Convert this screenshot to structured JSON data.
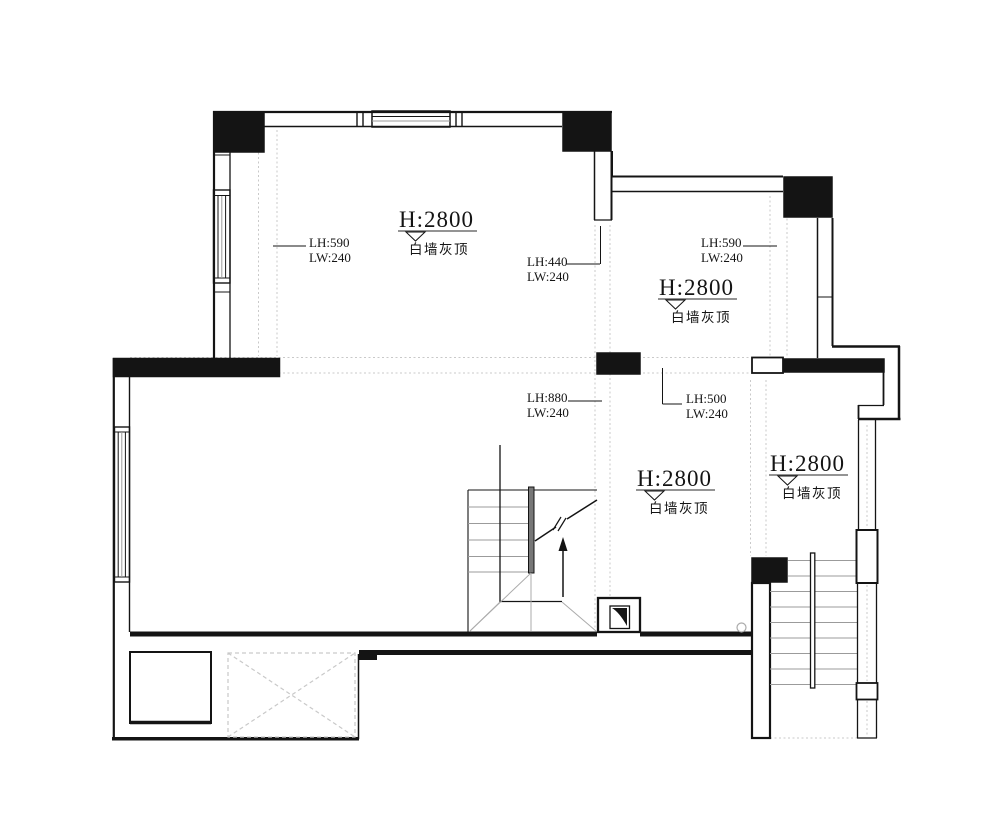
{
  "plan": {
    "background": "#ffffff",
    "colors": {
      "line": "#141414",
      "tread": "#9b9b9b",
      "guide": "#c9c9c9",
      "underline": "#555555",
      "fan": "#ababab"
    },
    "rooms": [
      {
        "id": "top-left",
        "height_label": "H:2800",
        "finish_label": "白墙灰顶"
      },
      {
        "id": "top-right",
        "height_label": "H:2800",
        "finish_label": "白墙灰顶"
      },
      {
        "id": "center",
        "height_label": "H:2800",
        "finish_label": "白墙灰顶"
      },
      {
        "id": "right",
        "height_label": "H:2800",
        "finish_label": "白墙灰顶"
      }
    ],
    "beams": [
      {
        "id": "left",
        "line1": "LH:590",
        "line2": "LW:240"
      },
      {
        "id": "center-top",
        "line1": "LH:440",
        "line2": "LW:240"
      },
      {
        "id": "right-top",
        "line1": "LH:590",
        "line2": "LW:240"
      },
      {
        "id": "center-mid",
        "line1": "LH:880",
        "line2": "LW:240"
      },
      {
        "id": "center-right",
        "line1": "LH:500",
        "line2": "LW:240"
      }
    ]
  }
}
